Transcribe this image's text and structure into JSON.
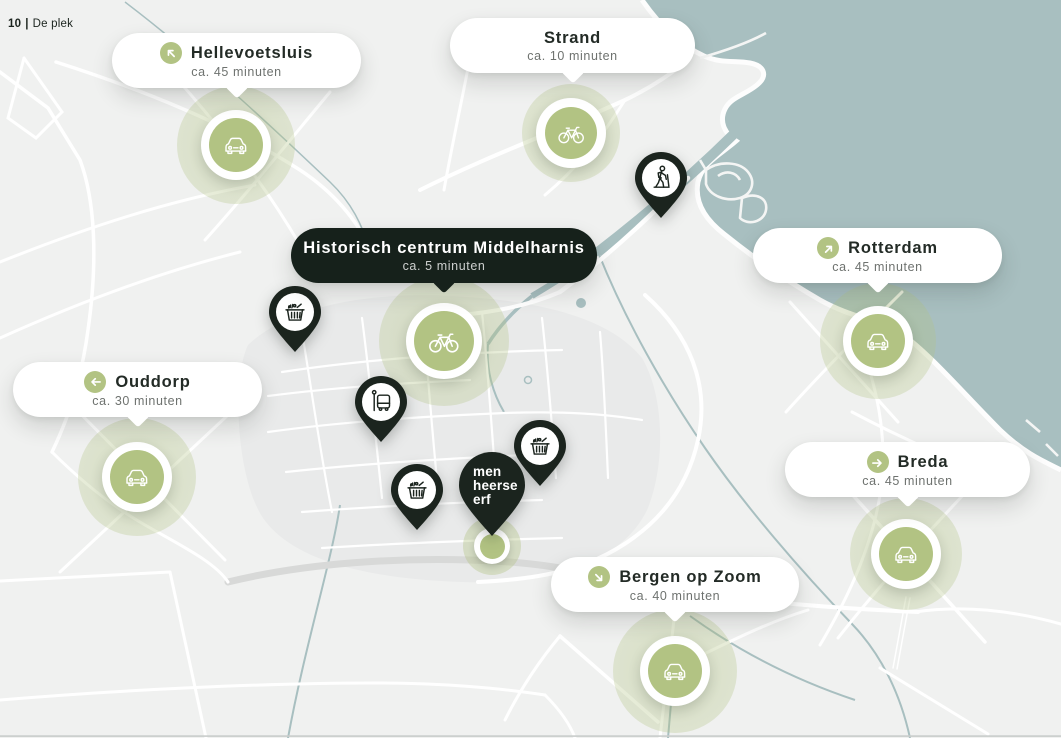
{
  "page_label": {
    "number": "10",
    "separator": "|",
    "text": "De plek"
  },
  "colors": {
    "accent_dark": "#1b241e",
    "accent_green": "#b2c383",
    "halo_green": "rgba(178,195,132,0.38)",
    "water": "#a8bfc0",
    "land": "#f0f1f0",
    "road": "#ffffff"
  },
  "map": {
    "destinations": [
      {
        "id": "hellevoetsluis",
        "title": "Hellevoetsluis",
        "subtitle": "ca. 45 minuten",
        "direction_icon": "arrow-up-left-icon",
        "marker_icon": "car-icon",
        "style": "light"
      },
      {
        "id": "strand",
        "title": "Strand",
        "subtitle": "ca. 10 minuten",
        "direction_icon": null,
        "marker_icon": "bicycle-icon",
        "style": "light"
      },
      {
        "id": "historisch-centrum",
        "title": "Historisch centrum Middelharnis",
        "subtitle": "ca. 5 minuten",
        "direction_icon": null,
        "marker_icon": "bicycle-icon",
        "style": "dark"
      },
      {
        "id": "rotterdam",
        "title": "Rotterdam",
        "subtitle": "ca. 45 minuten",
        "direction_icon": "arrow-up-right-icon",
        "marker_icon": "car-icon",
        "style": "light"
      },
      {
        "id": "ouddorp",
        "title": "Ouddorp",
        "subtitle": "ca. 30 minuten",
        "direction_icon": "arrow-left-icon",
        "marker_icon": "car-icon",
        "style": "light"
      },
      {
        "id": "breda",
        "title": "Breda",
        "subtitle": "ca. 45 minuten",
        "direction_icon": "arrow-right-icon",
        "marker_icon": "car-icon",
        "style": "light"
      },
      {
        "id": "bergen-op-zoom",
        "title": "Bergen op Zoom",
        "subtitle": "ca. 40 minuten",
        "direction_icon": "arrow-down-right-icon",
        "marker_icon": "car-icon",
        "style": "light"
      }
    ],
    "poi_pins": [
      {
        "id": "hiking-trail",
        "icon": "hiker-icon"
      },
      {
        "id": "supermarket-west",
        "icon": "shopping-basket-icon"
      },
      {
        "id": "bus-stop",
        "icon": "bus-icon"
      },
      {
        "id": "supermarket-center",
        "icon": "shopping-basket-icon"
      },
      {
        "id": "supermarket-east",
        "icon": "shopping-basket-icon"
      }
    ],
    "site": {
      "logo_lines": [
        "men",
        "heerse",
        "erf"
      ]
    }
  }
}
